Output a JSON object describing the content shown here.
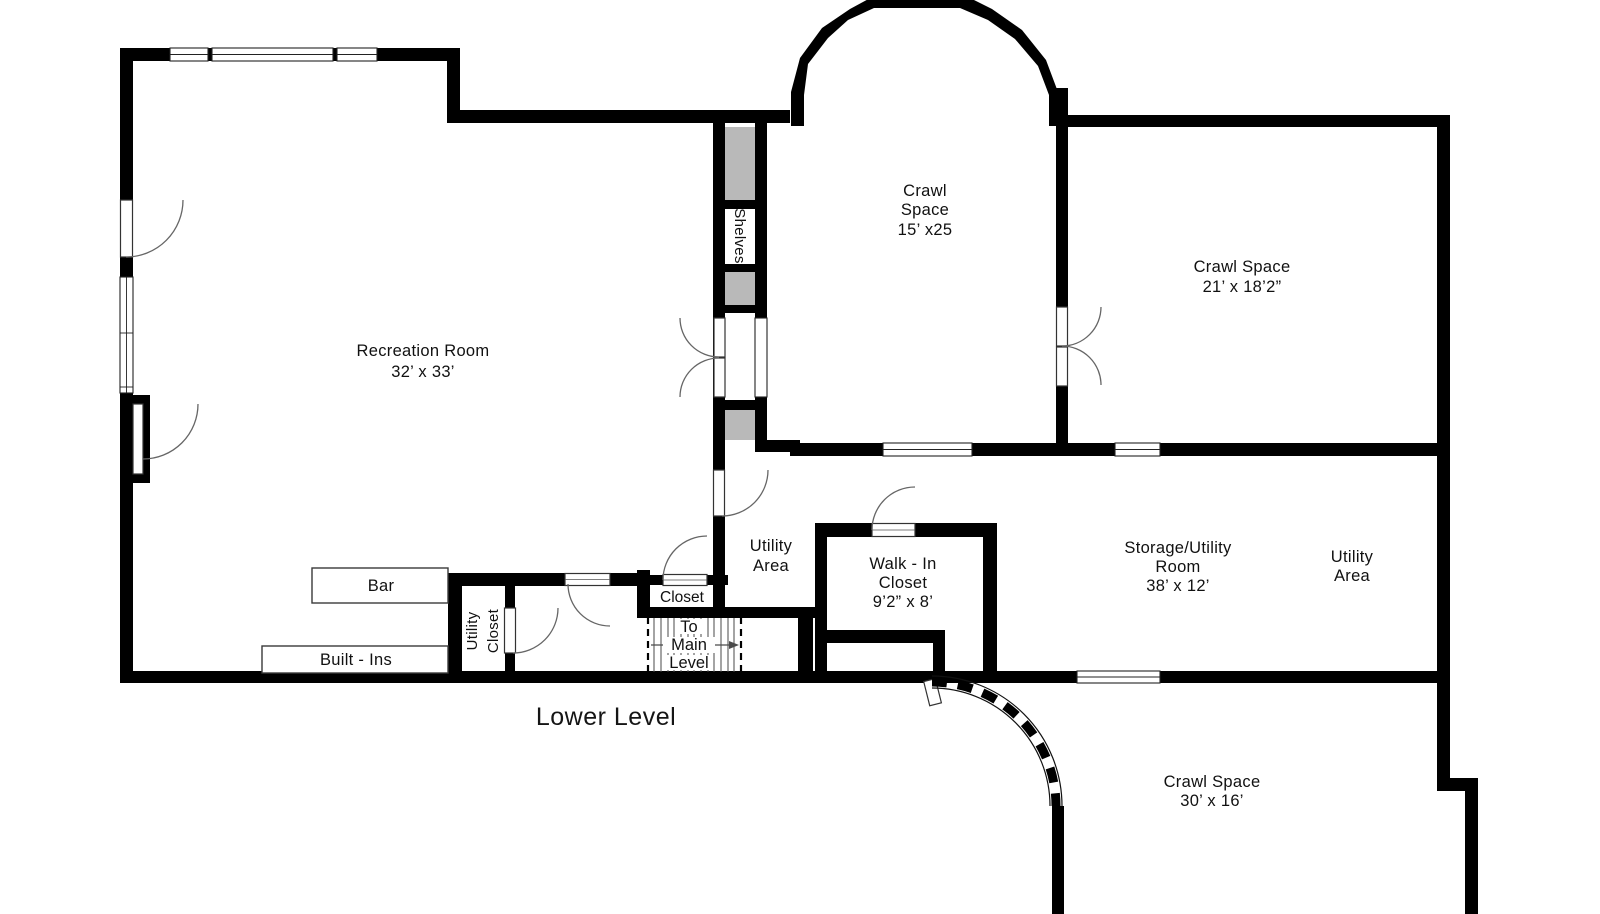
{
  "title": "Lower Level",
  "rooms": {
    "recreation": {
      "name": "Recreation Room",
      "dims": "32’ x 33’"
    },
    "crawl15": {
      "l1": "Crawl",
      "l2": "Space",
      "dims": "15’ x25"
    },
    "crawl21": {
      "name": "Crawl Space",
      "dims": "21’ x 18’2”"
    },
    "utility_left": {
      "l1": "Utility",
      "l2": "Area"
    },
    "walkin": {
      "l1": "Walk - In",
      "l2": "Closet",
      "dims": "9’2” x 8’"
    },
    "storage": {
      "l1": "Storage/Utility",
      "l2": "Room",
      "dims": "38’ x 12’"
    },
    "utility_right": {
      "l1": "Utility",
      "l2": "Area"
    },
    "crawl30": {
      "name": "Crawl Space",
      "dims": "30’ x 16’"
    },
    "closet": {
      "name": "Closet"
    },
    "utility_closet": {
      "l1": "Utility",
      "l2": "Closet"
    },
    "shelves": {
      "name": "Shelves"
    }
  },
  "furniture": {
    "bar": "Bar",
    "built_ins": "Built - Ins"
  },
  "stairs": {
    "l1": "To",
    "l2": "Main",
    "l3": "Level"
  },
  "colors": {
    "wall": "#000000",
    "shelf_fill": "#b9b9b9",
    "background": "#ffffff"
  }
}
